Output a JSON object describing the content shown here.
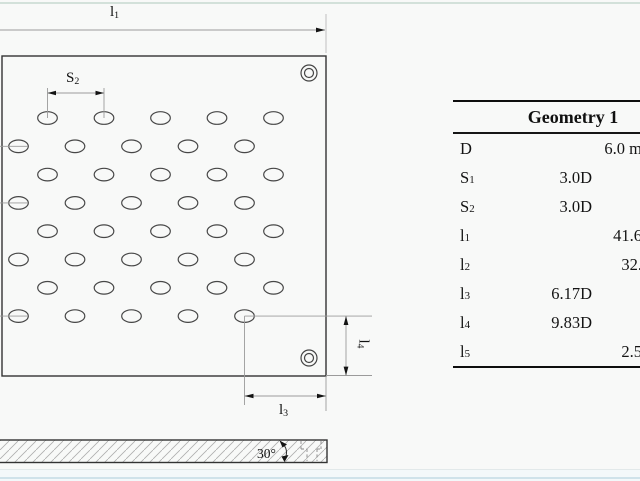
{
  "figure": {
    "description_labels": {
      "l1": {
        "main": "l",
        "sub": "1"
      },
      "s2": {
        "main": "S",
        "sub": "2"
      },
      "l3": {
        "main": "l",
        "sub": "3"
      },
      "l4": {
        "main": "l",
        "sub": "4"
      },
      "chamfer_angle": "30°"
    },
    "hole_grid": {
      "rows": 8,
      "cols": 5,
      "row_start_y": 118,
      "row_spacing": 28.3,
      "even_row_start_x": 47.5,
      "odd_row_start_x": 18.5,
      "col_spacing": 56.5,
      "rx": 9.8,
      "ry": 6.3
    }
  },
  "table": {
    "header": "Geometry 1",
    "rows": [
      {
        "param": "D",
        "sub": "",
        "d": "",
        "mm": "6.0 m"
      },
      {
        "param": "S",
        "sub": "1",
        "d": "3.0D",
        "mm": ""
      },
      {
        "param": "S",
        "sub": "2",
        "d": "3.0D",
        "mm": ""
      },
      {
        "param": "l",
        "sub": "1",
        "d": "",
        "mm": "41.6"
      },
      {
        "param": "l",
        "sub": "2",
        "d": "",
        "mm": "32."
      },
      {
        "param": "l",
        "sub": "3",
        "d": "6.17D",
        "mm": ""
      },
      {
        "param": "l",
        "sub": "4",
        "d": "9.83D",
        "mm": ""
      },
      {
        "param": "l",
        "sub": "5",
        "d": "",
        "mm": "2.5"
      }
    ]
  },
  "colors": {
    "background": "#f8f9f8",
    "plate_outline": "#333333",
    "dimension_line": "#9b9b9b",
    "arrow": "#141414",
    "table_rule": "#0e0e0e",
    "bottom_accent": "#cfe2ea",
    "top_accent": "#d3e1da"
  }
}
